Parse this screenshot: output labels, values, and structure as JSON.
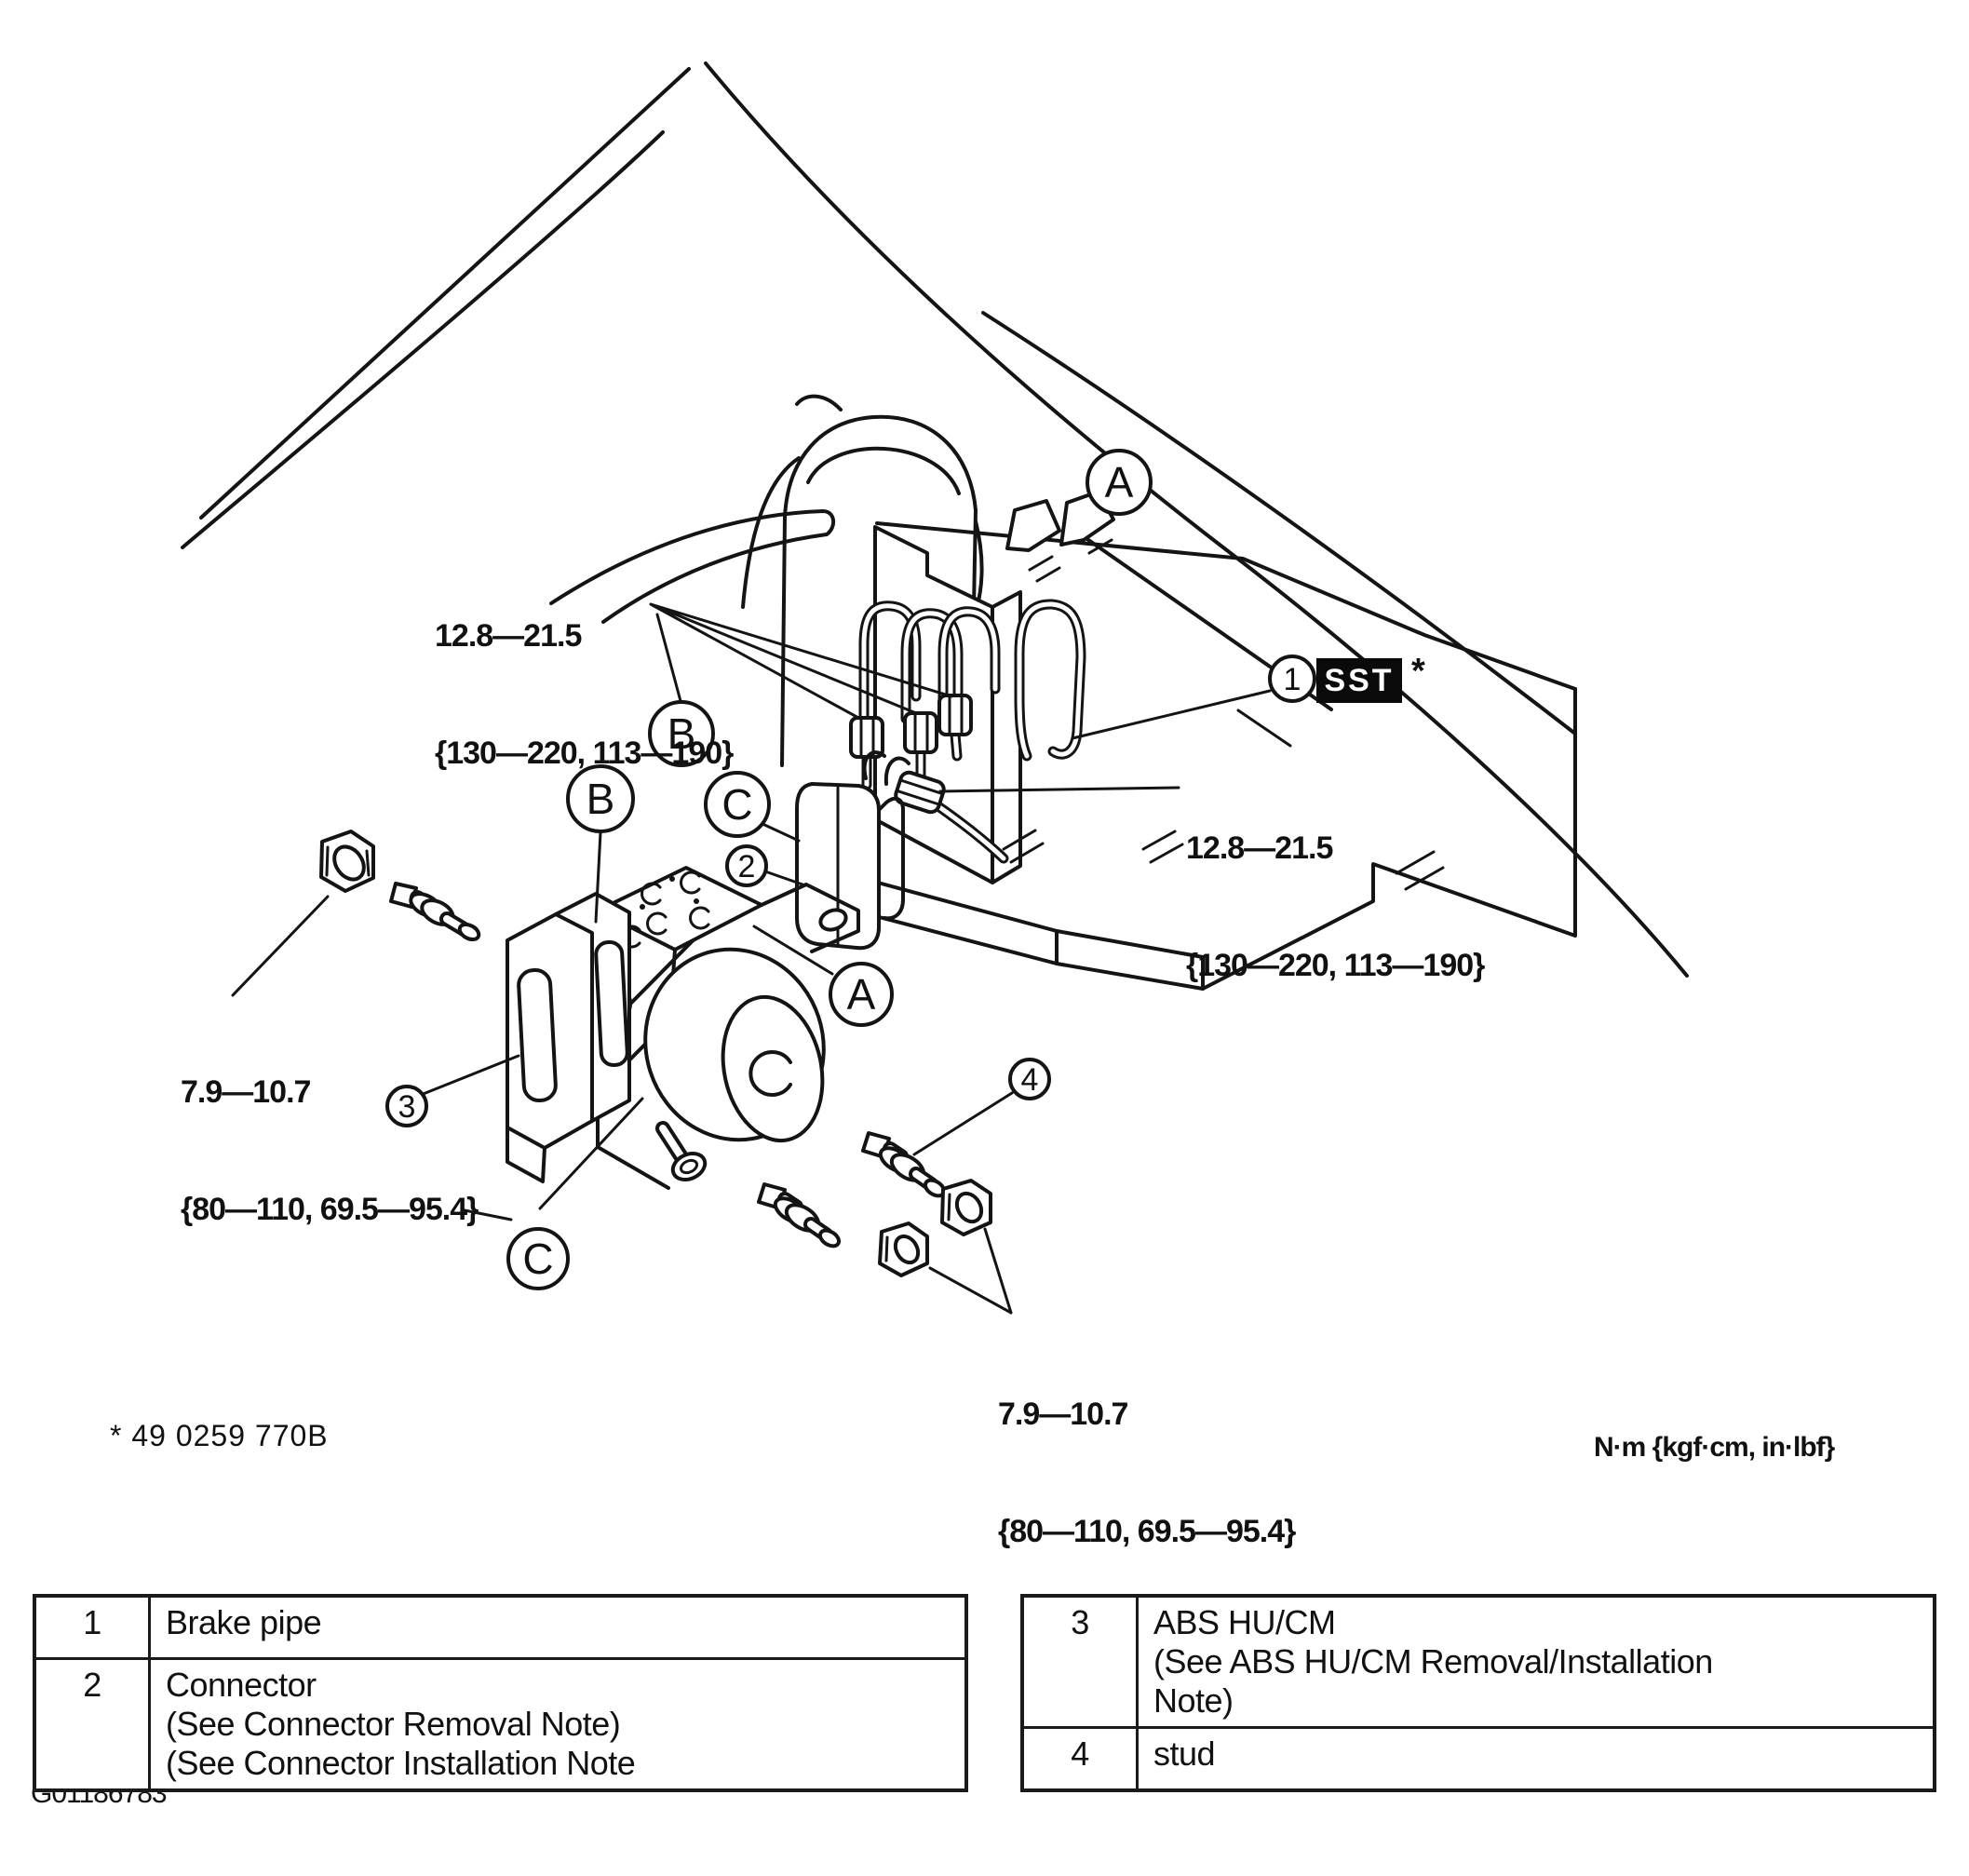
{
  "figure": {
    "sst_part_footnote": "* 49 0259 770B",
    "units_note": "N·m {kgf·cm, in·lbf}",
    "figure_id": "G01186783"
  },
  "sst": {
    "callout_number": "1",
    "badge": "SST",
    "footnote_marker": "*"
  },
  "torque_labels": {
    "brake_pipe_upper": {
      "line1": "12.8—21.5",
      "line2": "{130—220, 113—190}"
    },
    "brake_pipe_right": {
      "line1": "12.8—21.5",
      "line2": "{130—220, 113—190}"
    },
    "abs_nut_left": {
      "line1": "7.9—10.7",
      "line2": "{80—110, 69.5—95.4}"
    },
    "abs_nut_lower": {
      "line1": "7.9—10.7",
      "line2": "{80—110, 69.5—95.4}"
    }
  },
  "callouts": {
    "view_a_upper": "A",
    "view_b_upper": "B",
    "view_b_lower": "B",
    "view_c_upper": "C",
    "view_a_mid": "A",
    "view_c_lower": "C",
    "item_2": "2",
    "item_3": "3",
    "item_4": "4"
  },
  "legend_tables": {
    "left": {
      "rows": [
        {
          "num": "1",
          "desc": "Brake pipe"
        },
        {
          "num": "2",
          "desc": "Connector\n(See Connector Removal Note)\n(See Connector Installation Note"
        }
      ]
    },
    "right": {
      "rows": [
        {
          "num": "3",
          "desc": "ABS HU/CM\n(See ABS HU/CM Removal/Installation\nNote)"
        },
        {
          "num": "4",
          "desc": "stud"
        }
      ]
    }
  }
}
